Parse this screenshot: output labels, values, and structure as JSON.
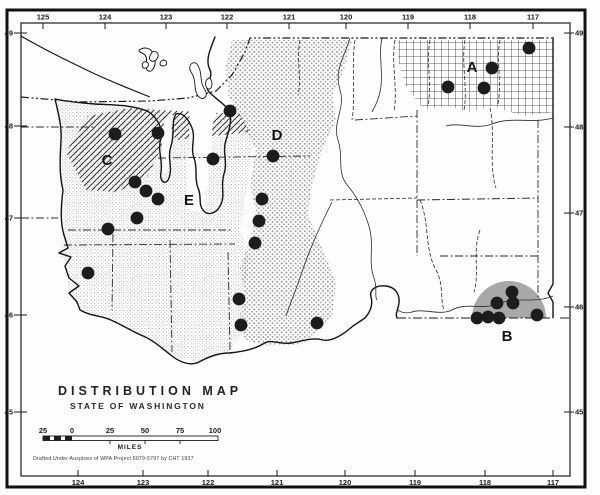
{
  "map": {
    "title": "DISTRIBUTION MAP",
    "subtitle": "STATE OF WASHINGTON",
    "credit": "Drafted Under Auspices of WPA Project 6079-5797 by CHT 1937",
    "scale_bar": {
      "unit": "MILES",
      "labels": [
        {
          "text": "25",
          "x": 43
        },
        {
          "text": "0",
          "x": 72
        },
        {
          "text": "25",
          "x": 110
        },
        {
          "text": "50",
          "x": 145
        },
        {
          "text": "75",
          "x": 180
        },
        {
          "text": "100",
          "x": 215
        }
      ]
    },
    "region_labels": [
      {
        "label": "A",
        "x": 472,
        "y": 72
      },
      {
        "label": "B",
        "x": 507,
        "y": 341
      },
      {
        "label": "C",
        "x": 107,
        "y": 165
      },
      {
        "label": "D",
        "x": 277,
        "y": 140
      },
      {
        "label": "E",
        "x": 189,
        "y": 205
      }
    ],
    "axes": {
      "top_longitude": [
        {
          "label": "125",
          "x": 43
        },
        {
          "label": "124",
          "x": 105
        },
        {
          "label": "123",
          "x": 166
        },
        {
          "label": "122",
          "x": 227
        },
        {
          "label": "121",
          "x": 289
        },
        {
          "label": "120",
          "x": 346
        },
        {
          "label": "119",
          "x": 408
        },
        {
          "label": "118",
          "x": 470
        },
        {
          "label": "117",
          "x": 533
        }
      ],
      "bottom_longitude": [
        {
          "label": "124",
          "x": 78
        },
        {
          "label": "123",
          "x": 143
        },
        {
          "label": "122",
          "x": 208
        },
        {
          "label": "121",
          "x": 277
        },
        {
          "label": "120",
          "x": 345
        },
        {
          "label": "119",
          "x": 415
        },
        {
          "label": "118",
          "x": 485
        },
        {
          "label": "117",
          "x": 553
        }
      ],
      "left_latitude": [
        {
          "label": "49",
          "y": 33
        },
        {
          "label": "48",
          "y": 126
        },
        {
          "label": "47",
          "y": 218
        },
        {
          "label": "46",
          "y": 315
        },
        {
          "label": "45",
          "y": 412
        }
      ],
      "right_latitude": [
        {
          "label": "49",
          "y": 33
        },
        {
          "label": "48",
          "y": 127
        },
        {
          "label": "47",
          "y": 213
        },
        {
          "label": "46",
          "y": 307
        },
        {
          "label": "45",
          "y": 412
        }
      ]
    },
    "dots": [
      [
        230,
        111
      ],
      [
        115,
        134
      ],
      [
        158,
        133
      ],
      [
        213,
        159
      ],
      [
        273,
        156
      ],
      [
        135,
        182
      ],
      [
        146,
        191
      ],
      [
        158,
        199
      ],
      [
        137,
        218
      ],
      [
        108,
        229
      ],
      [
        88,
        273
      ],
      [
        262,
        199
      ],
      [
        259,
        221
      ],
      [
        255,
        243
      ],
      [
        239,
        299
      ],
      [
        241,
        325
      ],
      [
        317,
        323
      ],
      [
        529,
        48
      ],
      [
        492,
        68
      ],
      [
        448,
        87
      ],
      [
        484,
        88
      ],
      [
        512,
        292
      ],
      [
        513,
        303
      ],
      [
        497,
        303
      ],
      [
        477,
        318
      ],
      [
        488,
        317
      ],
      [
        499,
        318
      ],
      [
        537,
        315
      ]
    ],
    "colors": {
      "ink": "#1c1c1c",
      "paper": "#fdfdfb",
      "region_b_gray": "#a8a8a8"
    }
  }
}
